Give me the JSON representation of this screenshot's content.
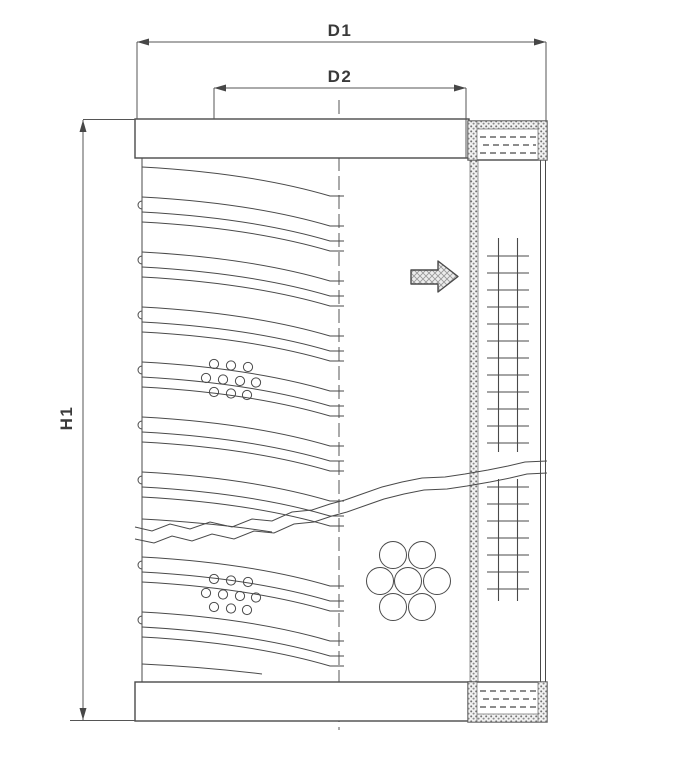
{
  "drawing": {
    "kind": "filter-element-cross-section"
  },
  "dimensions": {
    "d1": {
      "label": "D1"
    },
    "d2": {
      "label": "D2"
    },
    "h1": {
      "label": "H1"
    }
  },
  "icons": {
    "flow_direction": "block-arrow-right"
  },
  "colors": {
    "background": "#ffffff",
    "line": "#4a4a4a",
    "dimension_line": "#555555",
    "label_text": "#3a3a3a",
    "stipple_dot": "#707070",
    "arrow_fill": "#ededed"
  }
}
